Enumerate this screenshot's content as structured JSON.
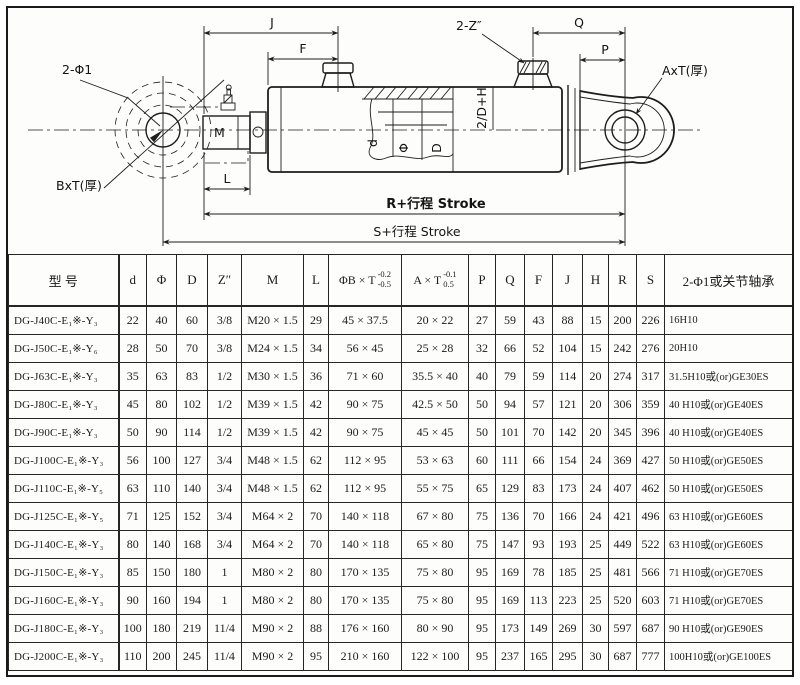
{
  "drawing": {
    "labels": {
      "j": "J",
      "f": "F",
      "ports_z": "2-Z″",
      "q": "Q",
      "p": "P",
      "axt": "AxT(厚)",
      "bxt": "BxT(厚)",
      "holes_phi1": "2-Φ1",
      "m": "M",
      "l": "L",
      "stroke_r": "R+行程  Stroke",
      "stroke_s": "S+行程  Stroke",
      "two_d_h": "2/D+H",
      "d_small": "d",
      "phi": "Φ",
      "d_big": "D"
    }
  },
  "table": {
    "columns": [
      {
        "key": "model",
        "label": "型      号"
      },
      {
        "key": "d",
        "label": "d"
      },
      {
        "key": "phi",
        "label": "Φ"
      },
      {
        "key": "D",
        "label": "D"
      },
      {
        "key": "Z",
        "label": "Z″"
      },
      {
        "key": "M",
        "label": "M"
      },
      {
        "key": "L",
        "label": "L"
      },
      {
        "key": "phiBxT",
        "label": "ΦB × T",
        "tol_top": "-0.2",
        "tol_bottom": "-0.5"
      },
      {
        "key": "AxT",
        "label": "A × T",
        "tol_top": "-0.1",
        "tol_bottom": "0.5"
      },
      {
        "key": "P",
        "label": "P"
      },
      {
        "key": "Q",
        "label": "Q"
      },
      {
        "key": "F",
        "label": "F"
      },
      {
        "key": "J",
        "label": "J"
      },
      {
        "key": "H",
        "label": "H"
      },
      {
        "key": "R",
        "label": "R"
      },
      {
        "key": "S",
        "label": "S"
      },
      {
        "key": "bearing",
        "label": "2-Φ1或关节轴承"
      }
    ],
    "rows": [
      [
        "DG-J40C-E₁※-Y₃",
        "22",
        "40",
        "60",
        "3/8",
        "M20 × 1.5",
        "29",
        "45 × 37.5",
        "20 × 22",
        "27",
        "59",
        "43",
        "88",
        "15",
        "200",
        "226",
        "16H10"
      ],
      [
        "DG-J50C-E₁※-Y₆",
        "28",
        "50",
        "70",
        "3/8",
        "M24 × 1.5",
        "34",
        "56 × 45",
        "25 × 28",
        "32",
        "66",
        "52",
        "104",
        "15",
        "242",
        "276",
        "20H10"
      ],
      [
        "DG-J63C-E₁※-Y₃",
        "35",
        "63",
        "83",
        "1/2",
        "M30 × 1.5",
        "36",
        "71 × 60",
        "35.5 × 40",
        "40",
        "79",
        "59",
        "114",
        "20",
        "274",
        "317",
        "31.5H10或(or)GE30ES"
      ],
      [
        "DG-J80C-E₁※-Y₃",
        "45",
        "80",
        "102",
        "1/2",
        "M39 × 1.5",
        "42",
        "90 × 75",
        "42.5 × 50",
        "50",
        "94",
        "57",
        "121",
        "20",
        "306",
        "359",
        "40 H10或(or)GE40ES"
      ],
      [
        "DG-J90C-E₁※-Y₃",
        "50",
        "90",
        "114",
        "1/2",
        "M39 × 1.5",
        "42",
        "90 × 75",
        "45 × 45",
        "50",
        "101",
        "70",
        "142",
        "20",
        "345",
        "396",
        "40 H10或(or)GE40ES"
      ],
      [
        "DG-J100C-E₁※-Y₃",
        "56",
        "100",
        "127",
        "3/4",
        "M48 × 1.5",
        "62",
        "112 × 95",
        "53 × 63",
        "60",
        "111",
        "66",
        "154",
        "24",
        "369",
        "427",
        "50 H10或(or)GE50ES"
      ],
      [
        "DG-J110C-E₁※-Y₅",
        "63",
        "110",
        "140",
        "3/4",
        "M48 × 1.5",
        "62",
        "112 × 95",
        "55 × 75",
        "65",
        "129",
        "83",
        "173",
        "24",
        "407",
        "462",
        "50 H10或(or)GE50ES"
      ],
      [
        "DG-J125C-E₁※-Y₅",
        "71",
        "125",
        "152",
        "3/4",
        "M64 × 2",
        "70",
        "140 × 118",
        "67 × 80",
        "75",
        "136",
        "70",
        "166",
        "24",
        "421",
        "496",
        "63 H10或(or)GE60ES"
      ],
      [
        "DG-J140C-E₁※-Y₃",
        "80",
        "140",
        "168",
        "3/4",
        "M64 × 2",
        "70",
        "140 × 118",
        "65 × 80",
        "75",
        "147",
        "93",
        "193",
        "25",
        "449",
        "522",
        "63 H10或(or)GE60ES"
      ],
      [
        "DG-J150C-E₁※-Y₃",
        "85",
        "150",
        "180",
        "1",
        "M80 × 2",
        "80",
        "170 × 135",
        "75 × 80",
        "95",
        "169",
        "78",
        "185",
        "25",
        "481",
        "566",
        "71 H10或(or)GE70ES"
      ],
      [
        "DG-J160C-E₁※-Y₃",
        "90",
        "160",
        "194",
        "1",
        "M80 × 2",
        "80",
        "170 × 135",
        "75 × 80",
        "95",
        "169",
        "113",
        "223",
        "25",
        "520",
        "603",
        "71 H10或(or)GE70ES"
      ],
      [
        "DG-J180C-E₁※-Y₃",
        "100",
        "180",
        "219",
        "11/4",
        "M90 × 2",
        "88",
        "176 × 160",
        "80 × 90",
        "95",
        "173",
        "149",
        "269",
        "30",
        "597",
        "687",
        "90 H10或(or)GE90ES"
      ],
      [
        "DG-J200C-E₁※-Y₃",
        "110",
        "200",
        "245",
        "11/4",
        "M90 × 2",
        "95",
        "210 × 160",
        "122 × 100",
        "95",
        "237",
        "165",
        "295",
        "30",
        "687",
        "777",
        "100H10或(or)GE100ES"
      ]
    ]
  }
}
